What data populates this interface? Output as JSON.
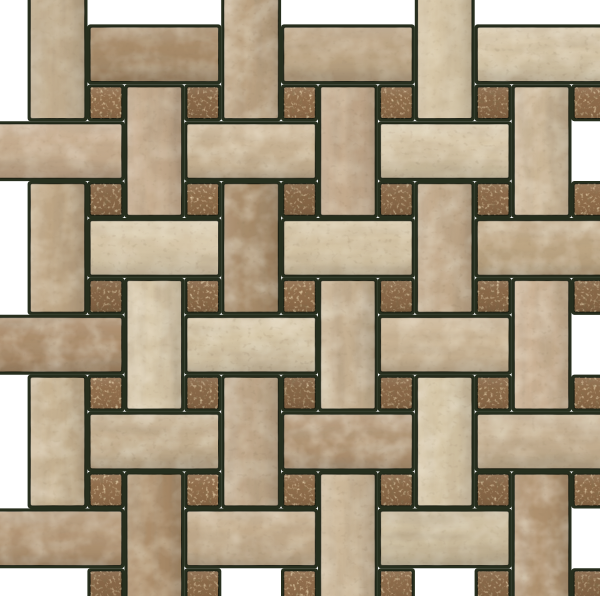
{
  "description": "Basketweave travertine stone mosaic tile sheet with small square glass-stone dot accents, dark grout, photographed on a white background with staggered interlocking sheet edges",
  "canvas": {
    "width": 600,
    "height": 596,
    "background": "#ffffff"
  },
  "pattern": {
    "type": "basketweave-with-dots",
    "period": 96.8,
    "origin_x": 187,
    "origin_y": 87,
    "dot_size": 31.5,
    "rect_long": 128.3,
    "rect_short": 54.3,
    "rect_offset": 37,
    "corner_radius": 2,
    "grout_pad": 2.8,
    "grout_color": "#272f1e",
    "cols_min": -2,
    "cols_max": 4,
    "rows_min": -1,
    "rows_max": 5,
    "dot_min_col": -1,
    "dot_min_row": 0,
    "rect_max_col": 3,
    "rect_max_row": 4
  },
  "palette": {
    "variants": [
      {
        "name": "cream",
        "base": "#d4c3a3",
        "vein_op": 0.4
      },
      {
        "name": "light-tan",
        "base": "#cab494",
        "vein_op": 0.5
      },
      {
        "name": "tan",
        "base": "#bfa684",
        "vein_op": 0.55
      },
      {
        "name": "pink-tan",
        "base": "#c8ae8f",
        "vein_op": 0.55
      },
      {
        "name": "brown",
        "base": "#ac8d6a",
        "vein_op": 0.65
      }
    ],
    "weights": [
      0.28,
      0.26,
      0.2,
      0.16,
      0.1
    ],
    "dot_base": "#8f6c4a",
    "textures": {
      "vein": "#6b5236",
      "mottle": "#efe3c0",
      "pit": "#4d3821",
      "sparkle": "#e2ba79",
      "dot_dark": "#402a13"
    },
    "edge_stroke": "rgba(22,26,14,0.9)",
    "background": "#ffffff"
  },
  "overrides": {
    "H,-2,2": "brown",
    "H,1,3": "brown",
    "V,0,-1": "tan",
    "V,-1,0": "pink-tan",
    "V,1,0": "pink-tan",
    "H,-1,1": "cream",
    "H,1,1": "cream",
    "H,0,2": "cream",
    "V,3,4": "brown",
    "H,3,3": "light-tan",
    "H,-1,3": "light-tan",
    "H,0,4": "tan",
    "V,-2,-1": "light-tan",
    "H,-2,0": "pink-tan"
  }
}
